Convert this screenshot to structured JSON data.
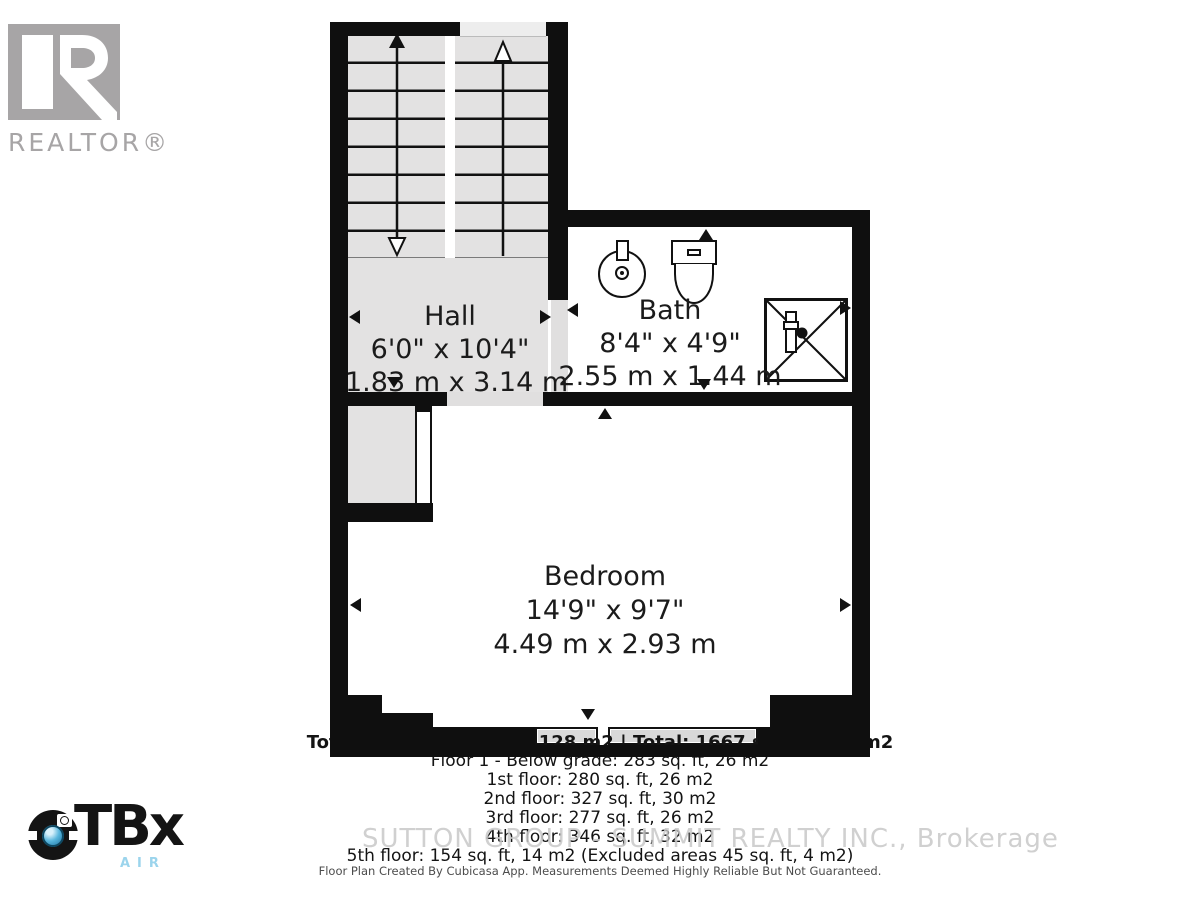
{
  "branding": {
    "realtor_logo_text": "REALTOR®",
    "otbx_brand": "TBx",
    "otbx_air": "AIR"
  },
  "rooms": {
    "hall": {
      "name": "Hall",
      "imperial": "6'0\" x 10'4\"",
      "metric": "1.83 m x 3.14 m"
    },
    "bath": {
      "name": "Bath",
      "imperial": "8'4\" x 4'9\"",
      "metric": "2.55 m x 1.44 m"
    },
    "bedroom": {
      "name": "Bedroom",
      "imperial": "14'9\" x 9'7\"",
      "metric": "4.49 m x 2.93 m"
    }
  },
  "summary": {
    "total_line": "Total GLA: 1384 sq. ft, 128 m2 | Total: 1667 sq. ft, 154 m2",
    "lines": [
      "Floor 1 - Below grade: 283 sq. ft, 26 m2",
      "1st floor: 280 sq. ft, 26 m2",
      "2nd floor: 327 sq. ft, 30 m2",
      "3rd floor: 277 sq. ft, 26 m2",
      "4th floor: 346 sq. ft, 32 m2",
      "5th floor: 154 sq. ft, 14 m2 (Excluded areas 45 sq. ft, 4 m2)"
    ]
  },
  "watermark": "SUTTON GROUP - SUMMIT REALTY INC., Brokerage",
  "footer": "Floor Plan Created By Cubicasa App. Measurements Deemed Highly Reliable But Not Guaranteed.",
  "colors": {
    "wall": "#0f0f0f",
    "floor_gray": "#e3e2e2",
    "door_gap": "#e0dfdf",
    "watermark_gray": "#c8c8c8",
    "realtor_gray": "#a7a5a6",
    "otbx_lens_blue": "#58b6dd",
    "otbx_air_blue": "#9bd4ec"
  }
}
